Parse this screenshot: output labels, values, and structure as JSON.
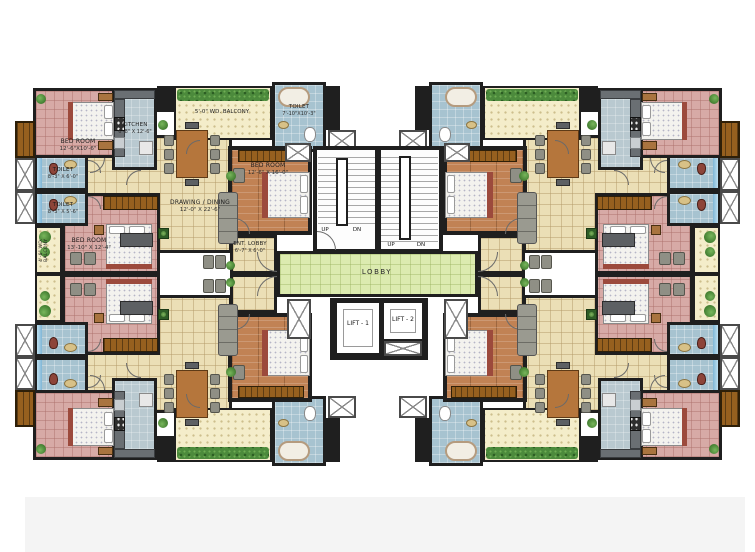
{
  "plan": {
    "units": {
      "bedroom1": {
        "name": "BED ROOM",
        "dims": "12'-6\"X10'-6\""
      },
      "kitchen": {
        "name": "KITCHEN",
        "dims": "6'-8\" X 12'-6\""
      },
      "toilet1": {
        "name": "TOILET",
        "dims": "8'-3\" X 6'-0\""
      },
      "toilet2": {
        "name": "TOILET",
        "dims": "8'-3\" X 5'-6\""
      },
      "toilet_master": {
        "name": "TOILET",
        "dims": "7'-10\"X10'-3\""
      },
      "balcony_top": {
        "name": "5'-0\" WD. BALCONY"
      },
      "balcony_side": {
        "name": "4'-6\" WD. BALCONY"
      },
      "drawing_dining": {
        "name": "DRAWING / DINING",
        "dims": "12'-0\" X 22'-6\""
      },
      "bedroom_master": {
        "name": "BED ROOM",
        "dims": "12'-6\" X 16'-0\""
      },
      "bedroom2": {
        "name": "BED ROOM",
        "dims": "13'-10\" X 12'-4\""
      },
      "ent_lobby": {
        "name": "ENT. LOBBY",
        "dims": "6'-7\" X 6'-0\""
      }
    },
    "core": {
      "lobby": "LOBBY",
      "lift1": "LIFT - 1",
      "lift2": "LIFT - 2",
      "up": "UP",
      "dn": "DN"
    },
    "colors": {
      "wall": "#1f1f1f",
      "bedroom_floor": "#d7aaa6",
      "living_floor": "#ebdfb6",
      "kitchen_floor": "#b9c9d0",
      "toilet_floor": "#a7c3d0",
      "wood_floor": "#c18254",
      "lobby_floor": "#dcebb0",
      "balcony_floor": "#f4edca",
      "hedge": "#4c8a3c"
    }
  }
}
